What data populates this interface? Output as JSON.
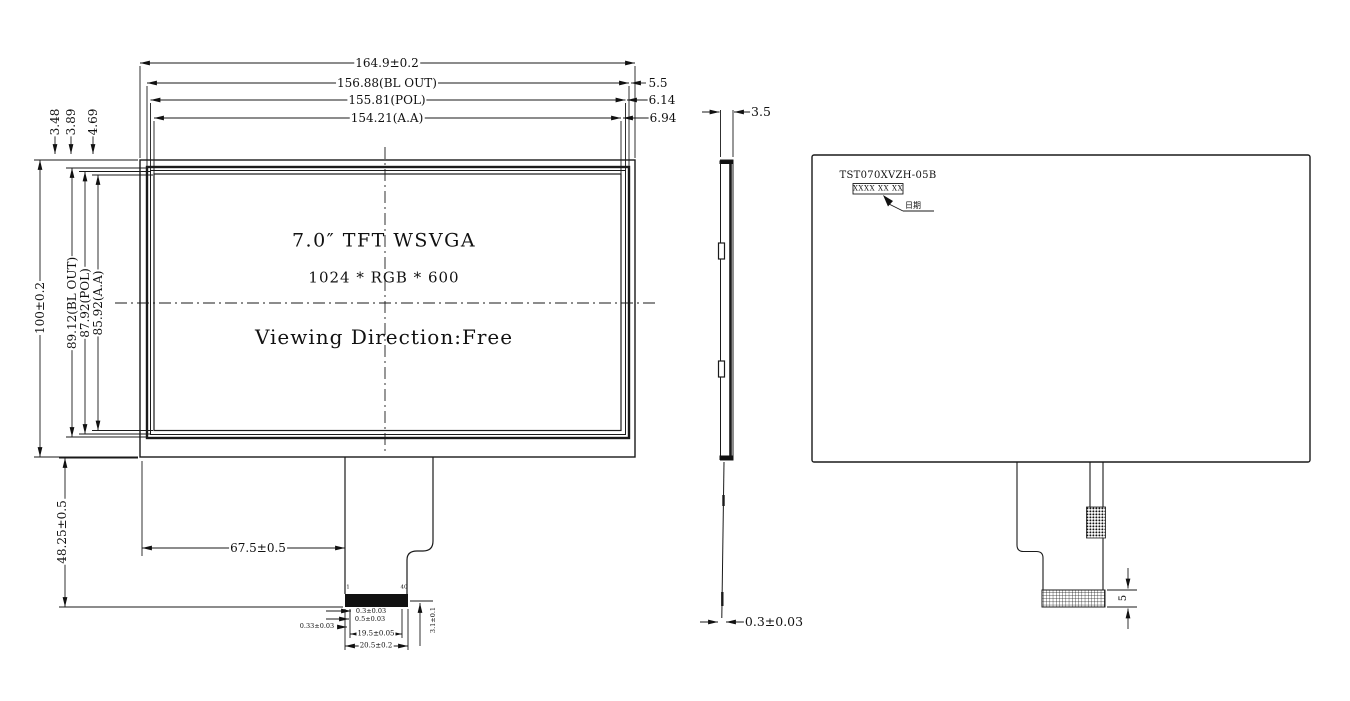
{
  "drawing": {
    "front_view": {
      "title": "7.0″ TFT WSVGA",
      "resolution": "1024 * RGB * 600",
      "viewing_direction": "Viewing Direction:Free",
      "dims": {
        "overall_width": "164.9±0.2",
        "bl_out_width": "156.88(BL OUT)",
        "pol_width": "155.81(POL)",
        "aa_width": "154.21(A.A)",
        "right_gap_bl": "5.5",
        "right_gap_pol": "6.14",
        "right_gap_aa": "6.94",
        "top_gap_bl": "3.48",
        "top_gap_pol": "3.89",
        "top_gap_aa": "4.69",
        "overall_height": "100±0.2",
        "bl_out_height": "89.12(BL OUT)",
        "pol_height": "87.92(POL)",
        "aa_height": "85.92(A.A)",
        "tail_offset": "67.5±0.5",
        "tail_length": "48.25±0.5",
        "fpc_contact_width": "0.3±0.03",
        "fpc_pitch": "0.5±0.03",
        "fpc_edge_margin": "0.33±0.03",
        "fpc_contact_span": "19.5±0.05",
        "fpc_width": "20.5±0.2",
        "fpc_stiffener_height": "3.1±0.1",
        "pin_first": "1",
        "pin_last": "40"
      }
    },
    "side_view": {
      "dims": {
        "thickness": "3.5",
        "fpc_thickness": "0.3±0.03"
      }
    },
    "back_view": {
      "part_number": "TST070XVZH-05B",
      "date_code": "XXXX XX XX",
      "date_label": "日期",
      "dims": {
        "connector_height": "5"
      }
    },
    "colors": {
      "line": "#1a1a1a",
      "background": "#ffffff"
    }
  }
}
